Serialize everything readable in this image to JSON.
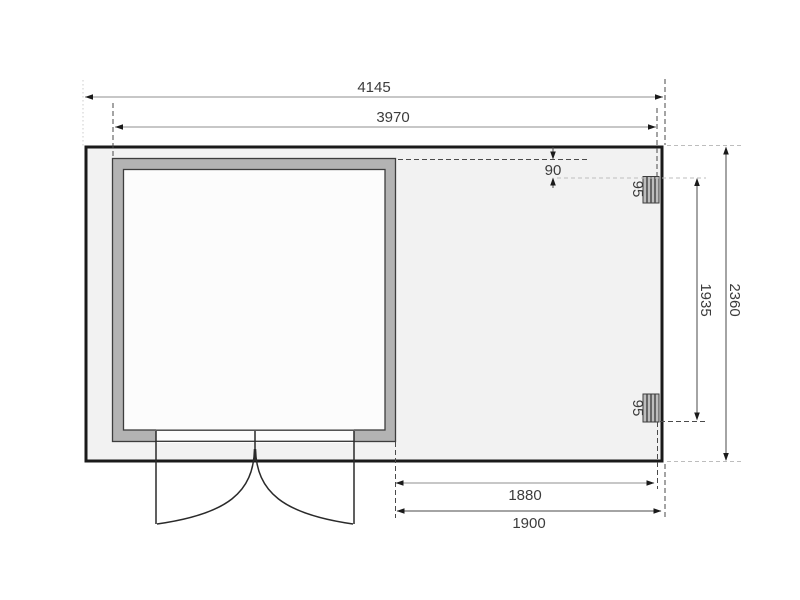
{
  "plan": {
    "type": "garden-house floor plan, top view",
    "dimensions": {
      "overall_width_mm": "4145",
      "shed_width_mm": "3970",
      "post_offset_mm": "90",
      "post_width_top_mm": "95",
      "post_width_bottom_mm": "95",
      "post_span_mm": "1935",
      "overall_depth_mm": "2360",
      "porch_clear_width_mm": "1880",
      "porch_width_mm": "1900"
    },
    "colors": {
      "background": "#ffffff",
      "building_fill": "#f2f2f2",
      "building_stroke": "#1a1a1a",
      "wall_fill": "#b3b3b3",
      "wall_stroke": "#3d3d3d",
      "room_fill": "#fcfcfc",
      "post_fill": "#bdbdbd",
      "dim_text": "#3c3c3c",
      "dim_line_gray": "#8f8f8f",
      "dim_line_dark": "#4a4a4a",
      "ext_light": "#bdbdbd"
    }
  }
}
